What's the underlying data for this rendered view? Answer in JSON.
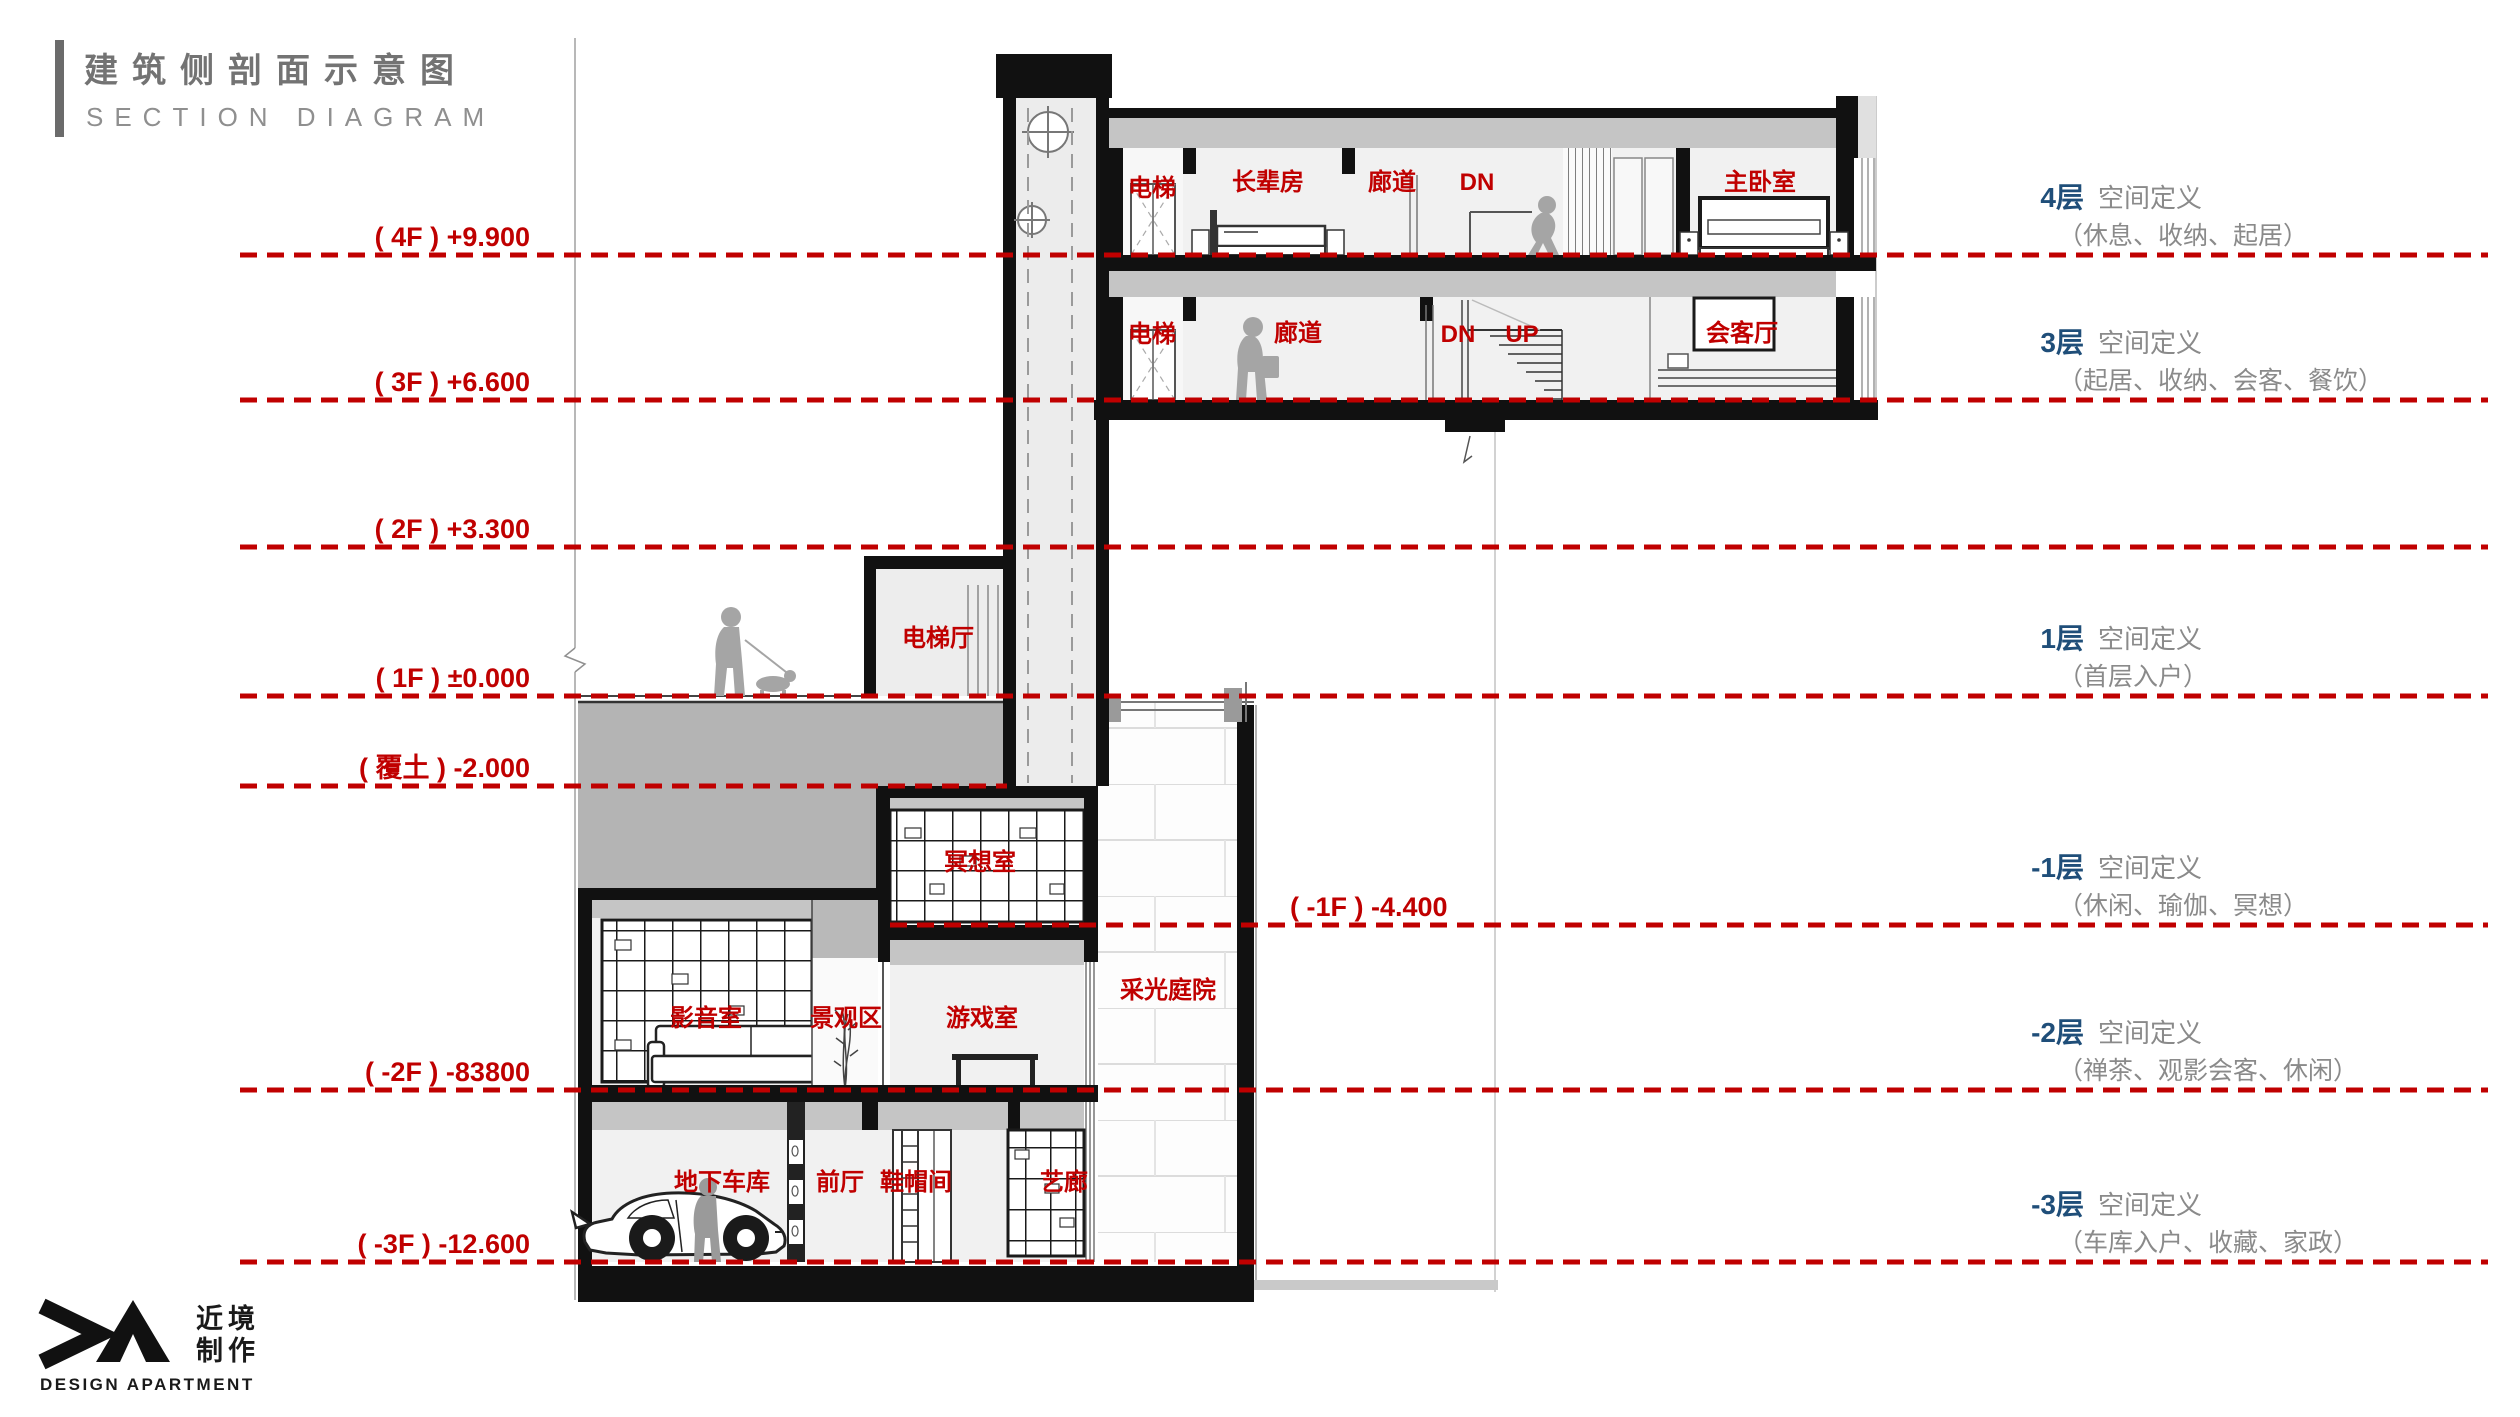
{
  "title": {
    "zh": "建筑侧剖面示意图",
    "en": "SECTION DIAGRAM"
  },
  "levels": {
    "f4": "( 4F ) +9.900",
    "f3": "( 3F ) +6.600",
    "f2": "( 2F ) +3.300",
    "f1": "( 1F ) ±0.000",
    "soil": "( 覆土 ) -2.000",
    "b1": "( -1F ) -4.400",
    "b2": "( -2F ) -83800",
    "b3": "( -3F ) -12.600"
  },
  "rooms": {
    "f4_elevator": "电梯",
    "f4_elder": "长辈房",
    "f4_corridor": "廊道",
    "f4_dn": "DN",
    "f4_master": "主卧室",
    "f3_elevator": "电梯",
    "f3_corridor": "廊道",
    "f3_dn": "DN",
    "f3_up": "UP",
    "f3_reception": "会客厅",
    "f1_hall": "电梯厅",
    "b1_meditation": "冥想室",
    "b2_cinema": "影音室",
    "b2_landscape": "景观区",
    "b2_game": "游戏室",
    "court": "采光庭院",
    "b3_garage": "地下车库",
    "b3_foyer": "前厅",
    "b3_shoe": "鞋帽间",
    "b3_gallery": "艺廊"
  },
  "floor_defs": {
    "d4": {
      "num": "4层",
      "title": "空间定义",
      "detail": "（休息、收纳、起居）"
    },
    "d3": {
      "num": "3层",
      "title": "空间定义",
      "detail": "（起居、收纳、会客、餐饮）"
    },
    "d1": {
      "num": "1层",
      "title": "空间定义",
      "detail": "（首层入户）"
    },
    "b1": {
      "num": "-1层",
      "title": "空间定义",
      "detail": "（休闲、瑜伽、冥想）"
    },
    "b2": {
      "num": "-2层",
      "title": "空间定义",
      "detail": "（禅茶、观影会客、休闲）"
    },
    "b3": {
      "num": "-3层",
      "title": "空间定义",
      "detail": "（车库入户、收藏、家政）"
    }
  },
  "logo": {
    "zh_top": "近境",
    "zh_bottom": "制作",
    "en": "DESIGN APARTMENT"
  },
  "colors": {
    "red": "#c00000",
    "blue": "#1f4e79",
    "gray_text": "#8a8a8a",
    "soil_gray": "#b4b4b4"
  }
}
